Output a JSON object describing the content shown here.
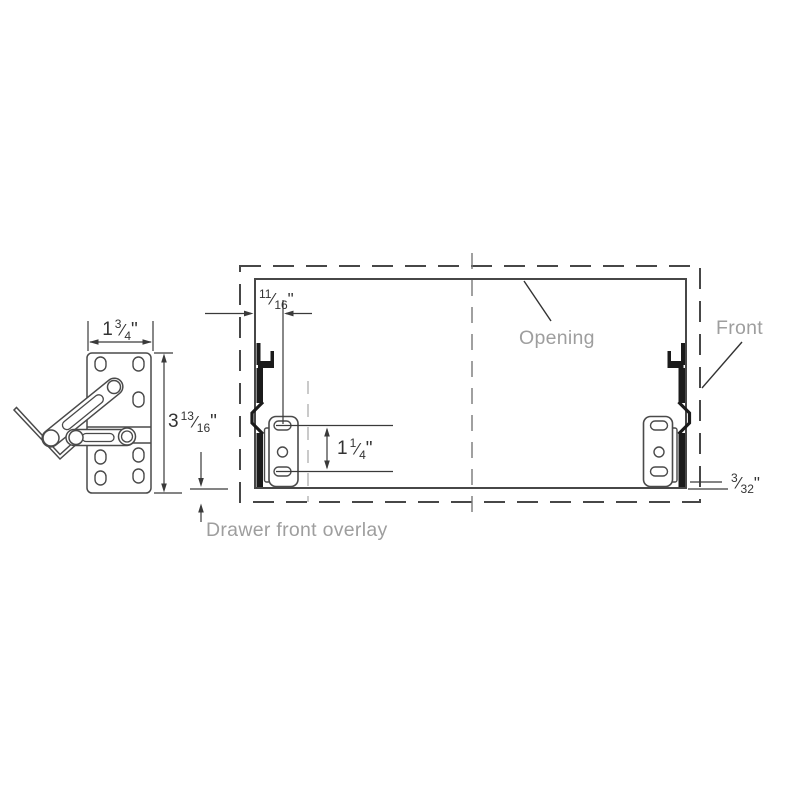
{
  "labels": {
    "opening": "Opening",
    "front": "Front",
    "drawer_front_overlay": "Drawer front overlay"
  },
  "fraction_slash": "⁄",
  "dimensions": {
    "bracket_width": {
      "whole": "1",
      "numerator": "3",
      "denominator": "4",
      "unit": "\""
    },
    "bracket_height": {
      "whole": "3",
      "numerator": "13",
      "denominator": "16",
      "unit": "\""
    },
    "edge_to_holes": {
      "whole": "",
      "numerator": "11",
      "denominator": "16",
      "unit": "\""
    },
    "hole_spacing": {
      "whole": "1",
      "numerator": "1",
      "denominator": "4",
      "unit": "\""
    },
    "bottom_gap": {
      "whole": "",
      "numerator": "3",
      "denominator": "32",
      "unit": "\""
    }
  },
  "colors": {
    "line_dark": "#3a3a3a",
    "outline": "#4a4a4a",
    "rail_fill": "#1b1b1b",
    "label_gray": "#9e9e9e",
    "hidden_line": "#b3b3b3"
  }
}
